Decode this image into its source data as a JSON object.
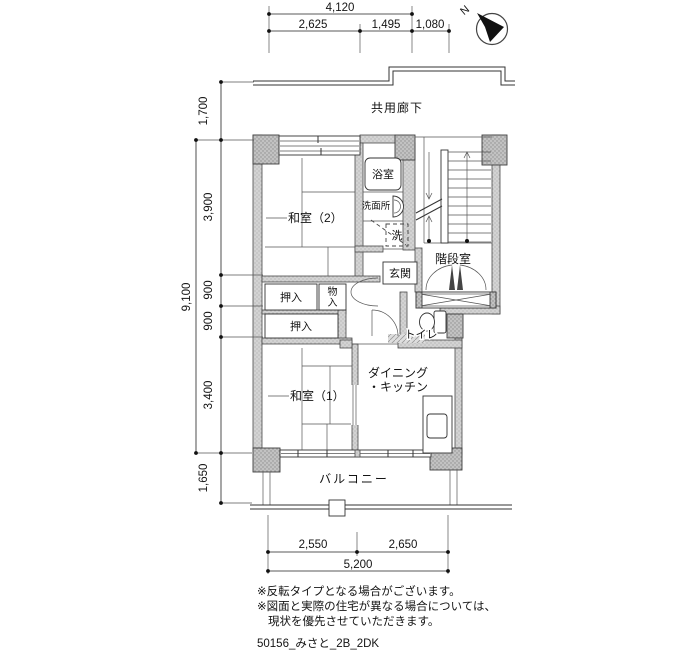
{
  "compass": {
    "north": "N"
  },
  "rooms": {
    "corridor": "共用廊下",
    "bath": "浴室",
    "washroom": "洗面所",
    "washer": "洗",
    "stairwell": "階段室",
    "entrance": "玄関",
    "toilet": "トイレ",
    "japanese_room_2": "和室（2）",
    "japanese_room_1": "和室（1）",
    "closet_upper": "押入",
    "closet_lower": "押入",
    "storage_char_1": "物",
    "storage_char_2": "入",
    "dining_line_1": "ダイニング",
    "dining_line_2": "・キッチン",
    "balcony": "バルコニー"
  },
  "dimensions": {
    "top": {
      "total": "4,120",
      "seg1": "2,625",
      "seg2": "1,495",
      "seg3": "1,080"
    },
    "left": {
      "corridor": "1,700",
      "total": "9,100",
      "seg1": "3,900",
      "seg2": "900",
      "seg3": "900",
      "seg4": "3,400",
      "balcony": "1,650"
    },
    "bottom": {
      "seg1": "2,550",
      "seg2": "2,650",
      "total": "5,200"
    }
  },
  "notes": {
    "line1": "※反転タイプとなる場合がございます。",
    "line2": "※図面と実際の住宅が異なる場合については、",
    "line3": "現状を優先させていただきます。",
    "code": "50156_みさと_2B_2DK"
  },
  "colors": {
    "wall_gray": "#cfcfcf",
    "column_gray": "#bdbdbd",
    "line_dark": "#333333"
  }
}
